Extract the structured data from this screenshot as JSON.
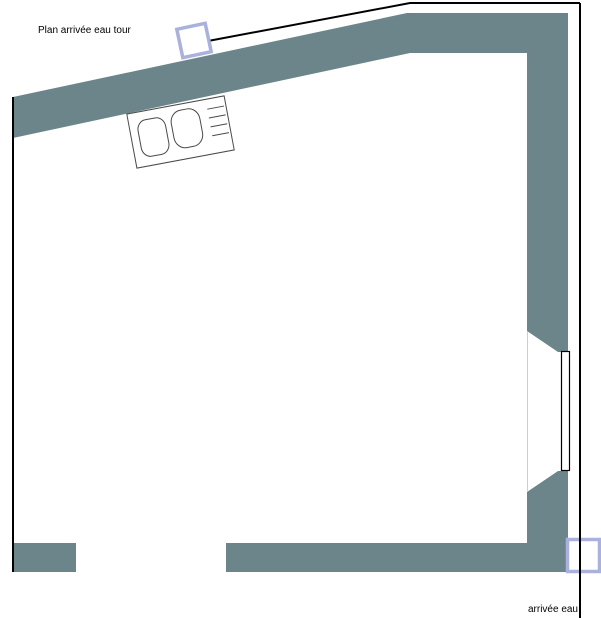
{
  "labels": {
    "plan_title": "Plan arrivée eau tour",
    "water_inlet": "arrivée eau"
  },
  "colors": {
    "wall": "#6c858a",
    "marker": "#a9b1dc",
    "outline": "#000000",
    "background": "#ffffff"
  },
  "elements": {
    "sink": "kitchen-sink-double-basin-with-drainer",
    "window": "window-right-wall",
    "marker_top": "water-inlet-tower-marker",
    "marker_bottom": "water-inlet-marker"
  }
}
